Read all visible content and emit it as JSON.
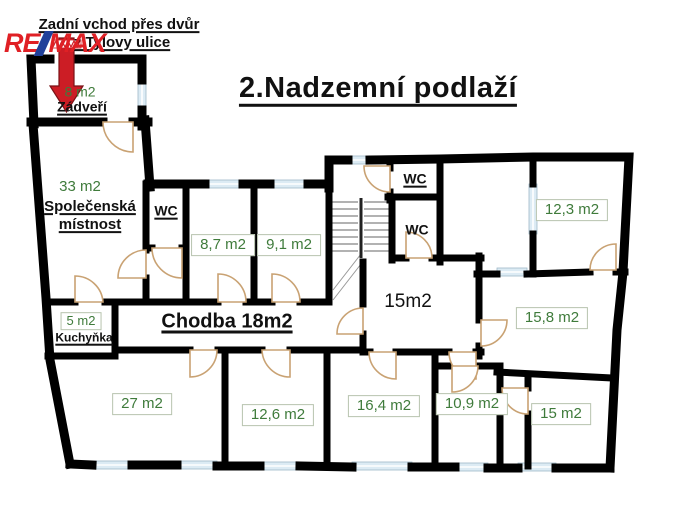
{
  "header": {
    "note_line1": "Zadní vchod přes dvůr",
    "note_line2": "z Tylovy ulice",
    "title": "2.Nadzemní podlaží"
  },
  "logo": {
    "re": "RE",
    "max": "MAX"
  },
  "colors": {
    "wall": "#000000",
    "area_text_green": "#3f7b3b",
    "window_fill": "#dcebf4",
    "door_stroke": "#c9a273",
    "arrow_red": "#cc1d25",
    "logo_red": "#e02025",
    "logo_blue": "#20409a"
  },
  "rooms": {
    "zadveri": {
      "area": "8 m2",
      "name": "Zádveří"
    },
    "spolecenska": {
      "area": "33 m2",
      "name_line1": "Společenská",
      "name_line2": "místnost"
    },
    "wc_left": {
      "name": "WC"
    },
    "r87": {
      "area": "8,7 m2"
    },
    "r91": {
      "area": "9,1 m2"
    },
    "wc_top": {
      "name": "WC"
    },
    "wc_mid": {
      "name": "WC"
    },
    "r123": {
      "area": "12,3 m2"
    },
    "r15c": {
      "area": "15m2"
    },
    "r158": {
      "area": "15,8 m2"
    },
    "kuchynka": {
      "area": "5 m2",
      "name": "Kuchyňka"
    },
    "chodba": {
      "name": "Chodba 18m2"
    },
    "r27": {
      "area": "27 m2"
    },
    "r126": {
      "area": "12,6 m2"
    },
    "r164": {
      "area": "16,4 m2"
    },
    "r109": {
      "area": "10,9 m2"
    },
    "r15r": {
      "area": "15 m2"
    }
  }
}
